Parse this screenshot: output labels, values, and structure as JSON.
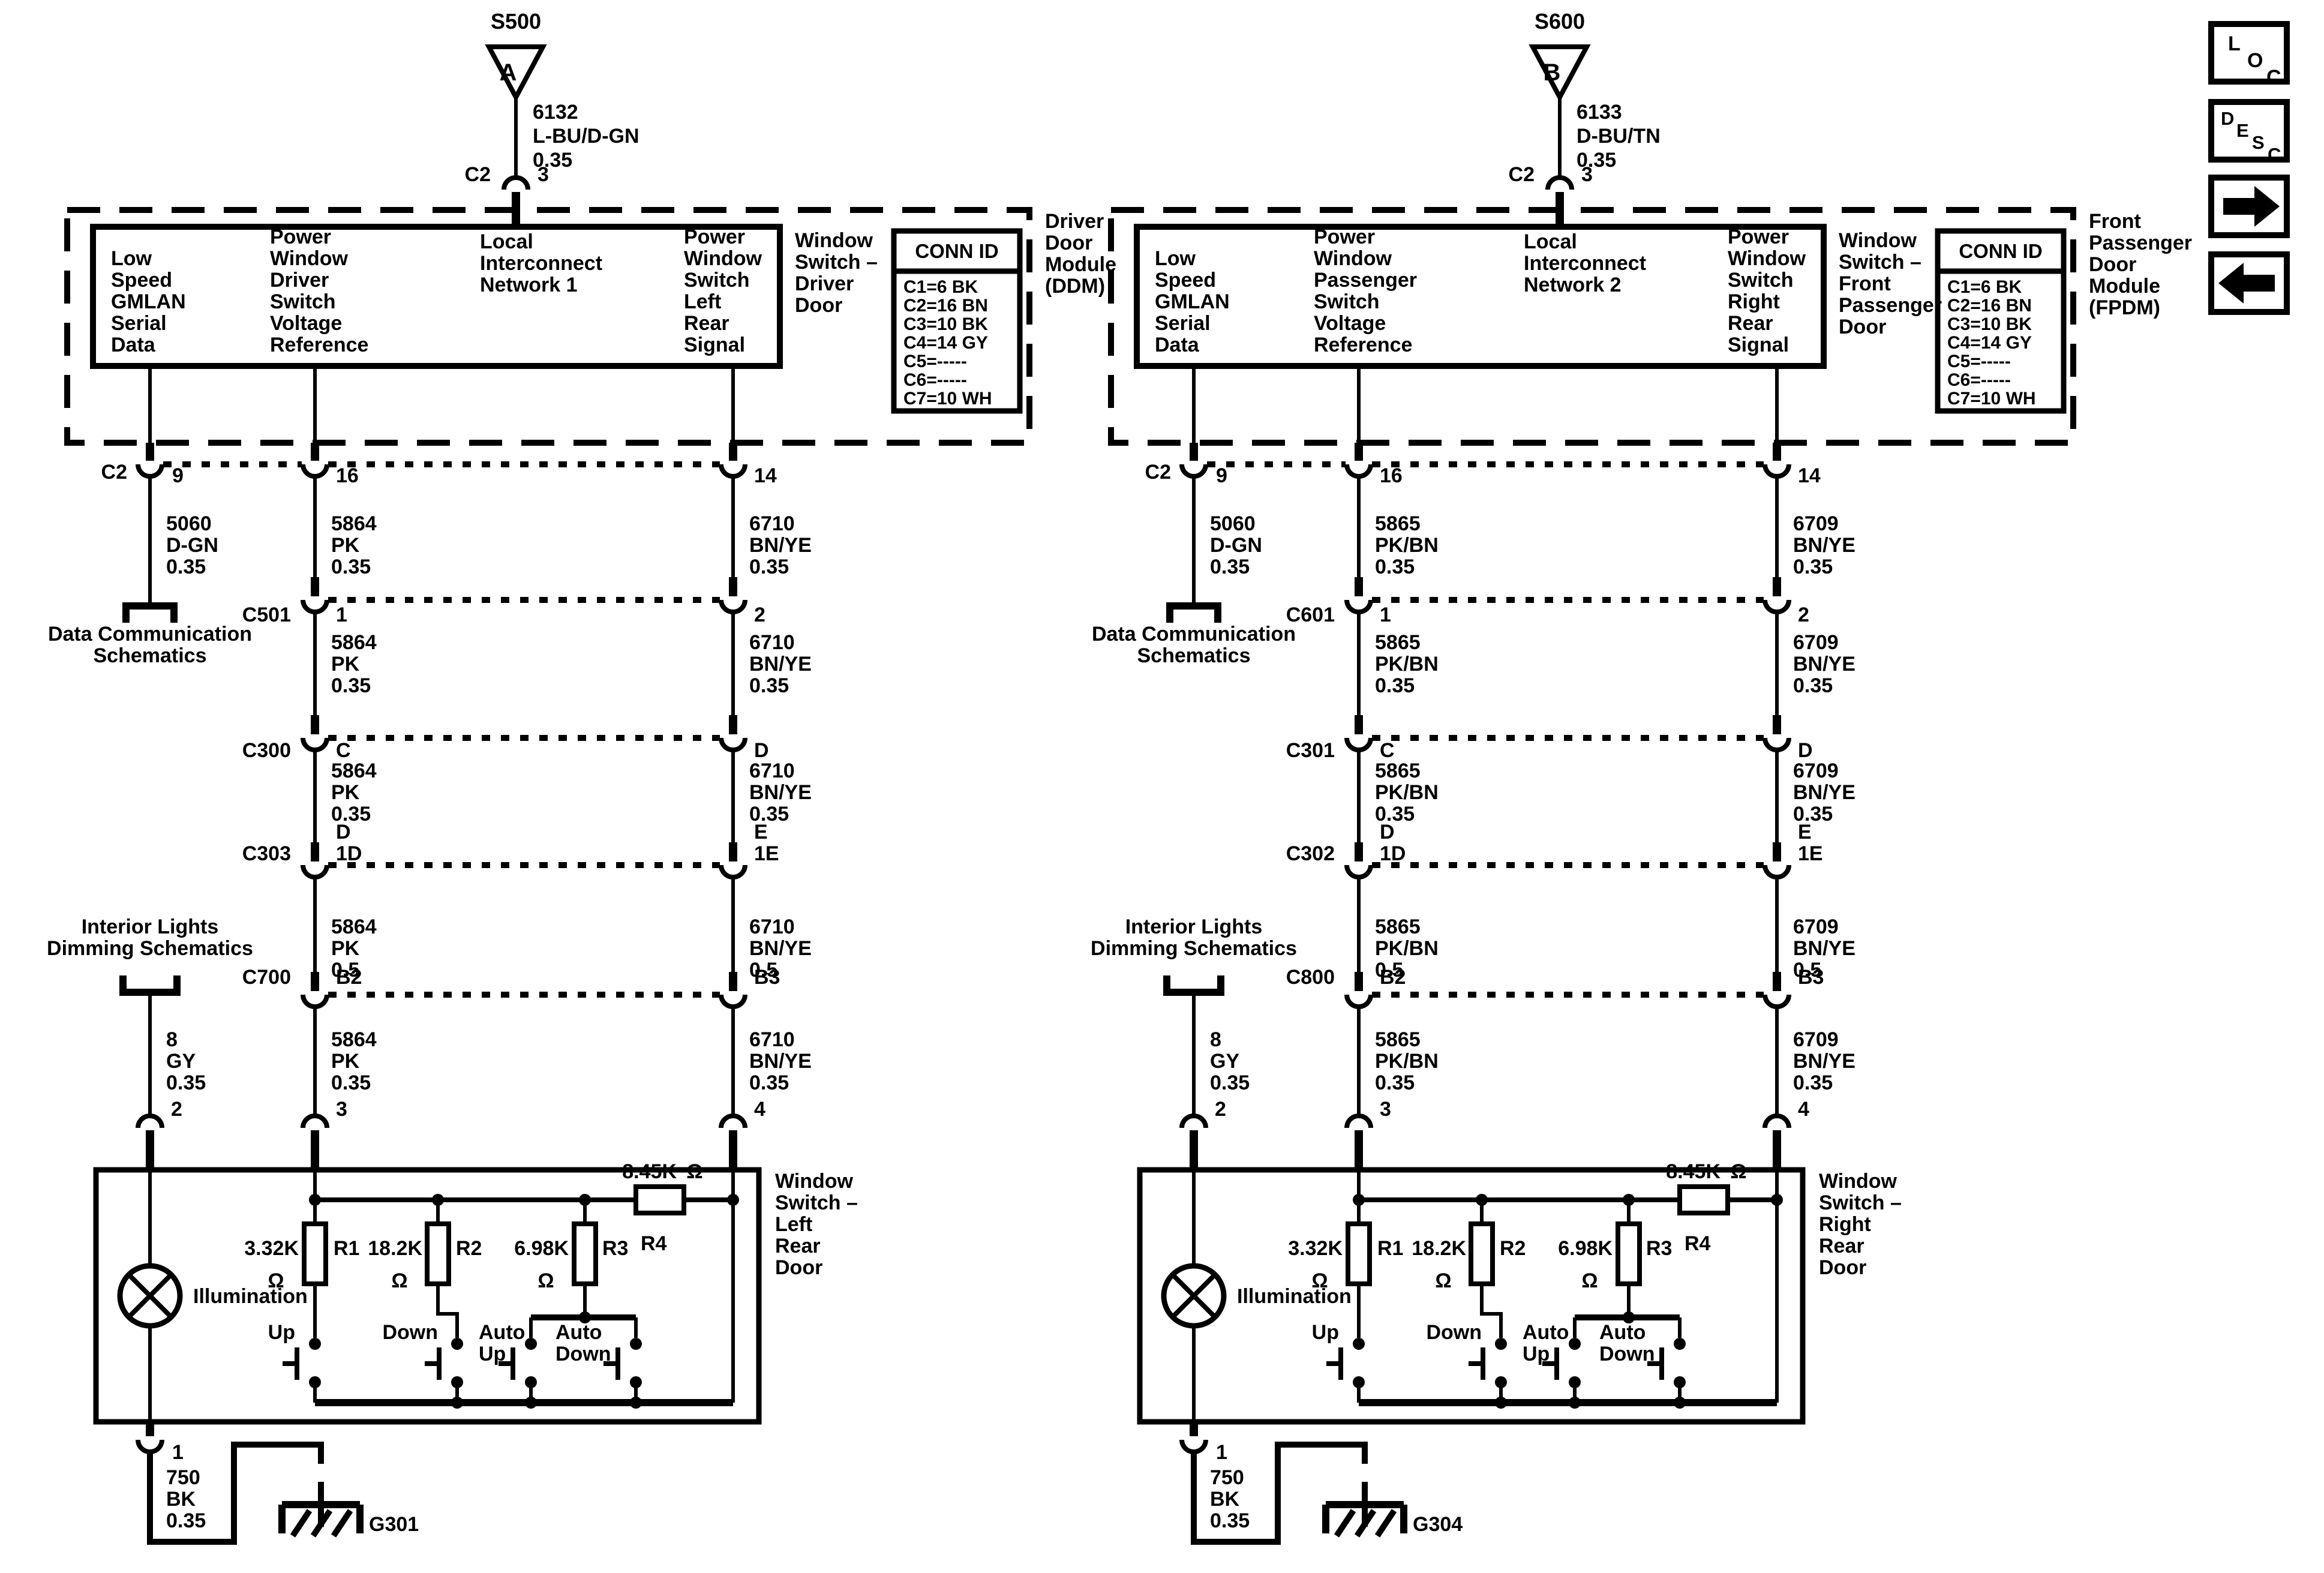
{
  "ohm": "Ω",
  "nav": {
    "loc": [
      "L",
      "O",
      "C"
    ],
    "desc": [
      "D",
      "E",
      "S",
      "C"
    ]
  },
  "left": {
    "splice": {
      "id": "S500",
      "letter": "A"
    },
    "splice_wire": [
      "6132",
      "L-BU/D-GN",
      "0.35"
    ],
    "top_conn": {
      "name": "C2",
      "pin": "3"
    },
    "module": {
      "col1": [
        "Low",
        "Speed",
        "GMLAN",
        "Serial",
        "Data"
      ],
      "col2": [
        "Power",
        "Window",
        "Driver",
        "Switch",
        "Voltage",
        "Reference"
      ],
      "col3": [
        "Local",
        "Interconnect",
        "Network 1"
      ],
      "col4": [
        "Power",
        "Window",
        "Switch",
        "Left",
        "Rear",
        "Signal"
      ],
      "box_label": [
        "Window",
        "Switch –",
        "Driver",
        "Door"
      ],
      "module_label": [
        "Driver",
        "Door",
        "Module",
        "(DDM)"
      ],
      "conn_id": {
        "title": "CONN ID",
        "rows": [
          "C1=6 BK",
          "C2=16 BN",
          "C3=10 BK",
          "C4=14 GY",
          "C5=-----",
          "C6=-----",
          "C7=10 WH"
        ]
      }
    },
    "conn_c2": {
      "name": "C2",
      "pins": [
        "9",
        "16",
        "14"
      ]
    },
    "wires1": [
      [
        "5060",
        "D-GN",
        "0.35"
      ],
      [
        "5864",
        "PK",
        "0.35"
      ],
      [
        "6710",
        "BN/YE",
        "0.35"
      ]
    ],
    "data_comm": [
      "Data Communication",
      "Schematics"
    ],
    "c501": {
      "name": "C501",
      "pins": [
        "1",
        "2"
      ]
    },
    "wires2": [
      [
        "5864",
        "PK",
        "0.35"
      ],
      [
        "6710",
        "BN/YE",
        "0.35"
      ]
    ],
    "c300": {
      "name": "C300",
      "pins": [
        "C",
        "D"
      ]
    },
    "wires3": [
      [
        "5864",
        "PK",
        "0.35"
      ],
      [
        "6710",
        "BN/YE",
        "0.35"
      ]
    ],
    "c303": {
      "name": "C303",
      "pins_top": [
        "D",
        "E"
      ],
      "pins_bot": [
        "1D",
        "1E"
      ]
    },
    "wires4": [
      [
        "5864",
        "PK",
        "0.5"
      ],
      [
        "6710",
        "BN/YE",
        "0.5"
      ]
    ],
    "interior": [
      "Interior Lights",
      "Dimming Schematics"
    ],
    "c700": {
      "name": "C700",
      "pins": [
        "B2",
        "B3"
      ]
    },
    "wires5": [
      [
        "8",
        "GY",
        "0.35"
      ],
      [
        "5864",
        "PK",
        "0.35"
      ],
      [
        "6710",
        "BN/YE",
        "0.35"
      ]
    ],
    "switch": {
      "pins_top": [
        "2",
        "3",
        "4"
      ],
      "label": [
        "Window",
        "Switch –",
        "Left",
        "Rear",
        "Door"
      ],
      "illumination": "Illumination",
      "r1": {
        "v": "3.32K",
        "n": "R1"
      },
      "r2": {
        "v": "18.2K",
        "n": "R2"
      },
      "r3": {
        "v": "6.98K",
        "n": "R3"
      },
      "r4": {
        "v": "8.45K",
        "n": "R4"
      },
      "sw_up": "Up",
      "sw_down": "Down",
      "sw_auto_up": [
        "Auto",
        "Up"
      ],
      "sw_auto_down": [
        "Auto",
        "Down"
      ],
      "pin_bottom": "1",
      "gnd_wire": [
        "750",
        "BK",
        "0.35"
      ],
      "ground": "G301"
    }
  },
  "right": {
    "splice": {
      "id": "S600",
      "letter": "B"
    },
    "splice_wire": [
      "6133",
      "D-BU/TN",
      "0.35"
    ],
    "top_conn": {
      "name": "C2",
      "pin": "3"
    },
    "module": {
      "col1": [
        "Low",
        "Speed",
        "GMLAN",
        "Serial",
        "Data"
      ],
      "col2": [
        "Power",
        "Window",
        "Passenger",
        "Switch",
        "Voltage",
        "Reference"
      ],
      "col3": [
        "Local",
        "Interconnect",
        "Network 2"
      ],
      "col4": [
        "Power",
        "Window",
        "Switch",
        "Right",
        "Rear",
        "Signal"
      ],
      "box_label": [
        "Window",
        "Switch –",
        "Front",
        "Passenger",
        "Door"
      ],
      "module_label": [
        "Front",
        "Passenger",
        "Door",
        "Module",
        "(FPDM)"
      ],
      "conn_id": {
        "title": "CONN ID",
        "rows": [
          "C1=6 BK",
          "C2=16 BN",
          "C3=10 BK",
          "C4=14 GY",
          "C5=-----",
          "C6=-----",
          "C7=10 WH"
        ]
      }
    },
    "conn_c2": {
      "name": "C2",
      "pins": [
        "9",
        "16",
        "14"
      ]
    },
    "wires1": [
      [
        "5060",
        "D-GN",
        "0.35"
      ],
      [
        "5865",
        "PK/BN",
        "0.35"
      ],
      [
        "6709",
        "BN/YE",
        "0.35"
      ]
    ],
    "data_comm": [
      "Data Communication",
      "Schematics"
    ],
    "c501": {
      "name": "C601",
      "pins": [
        "1",
        "2"
      ]
    },
    "wires2": [
      [
        "5865",
        "PK/BN",
        "0.35"
      ],
      [
        "6709",
        "BN/YE",
        "0.35"
      ]
    ],
    "c300": {
      "name": "C301",
      "pins": [
        "C",
        "D"
      ]
    },
    "wires3": [
      [
        "5865",
        "PK/BN",
        "0.35"
      ],
      [
        "6709",
        "BN/YE",
        "0.35"
      ]
    ],
    "c303": {
      "name": "C302",
      "pins_top": [
        "D",
        "E"
      ],
      "pins_bot": [
        "1D",
        "1E"
      ]
    },
    "wires4": [
      [
        "5865",
        "PK/BN",
        "0.5"
      ],
      [
        "6709",
        "BN/YE",
        "0.5"
      ]
    ],
    "interior": [
      "Interior Lights",
      "Dimming Schematics"
    ],
    "c700": {
      "name": "C800",
      "pins": [
        "B2",
        "B3"
      ]
    },
    "wires5": [
      [
        "8",
        "GY",
        "0.35"
      ],
      [
        "5865",
        "PK/BN",
        "0.35"
      ],
      [
        "6709",
        "BN/YE",
        "0.35"
      ]
    ],
    "switch": {
      "pins_top": [
        "2",
        "3",
        "4"
      ],
      "label": [
        "Window",
        "Switch –",
        "Right",
        "Rear",
        "Door"
      ],
      "illumination": "Illumination",
      "r1": {
        "v": "3.32K",
        "n": "R1"
      },
      "r2": {
        "v": "18.2K",
        "n": "R2"
      },
      "r3": {
        "v": "6.98K",
        "n": "R3"
      },
      "r4": {
        "v": "8.45K",
        "n": "R4"
      },
      "sw_up": "Up",
      "sw_down": "Down",
      "sw_auto_up": [
        "Auto",
        "Up"
      ],
      "sw_auto_down": [
        "Auto",
        "Down"
      ],
      "pin_bottom": "1",
      "gnd_wire": [
        "750",
        "BK",
        "0.35"
      ],
      "ground": "G304"
    }
  }
}
